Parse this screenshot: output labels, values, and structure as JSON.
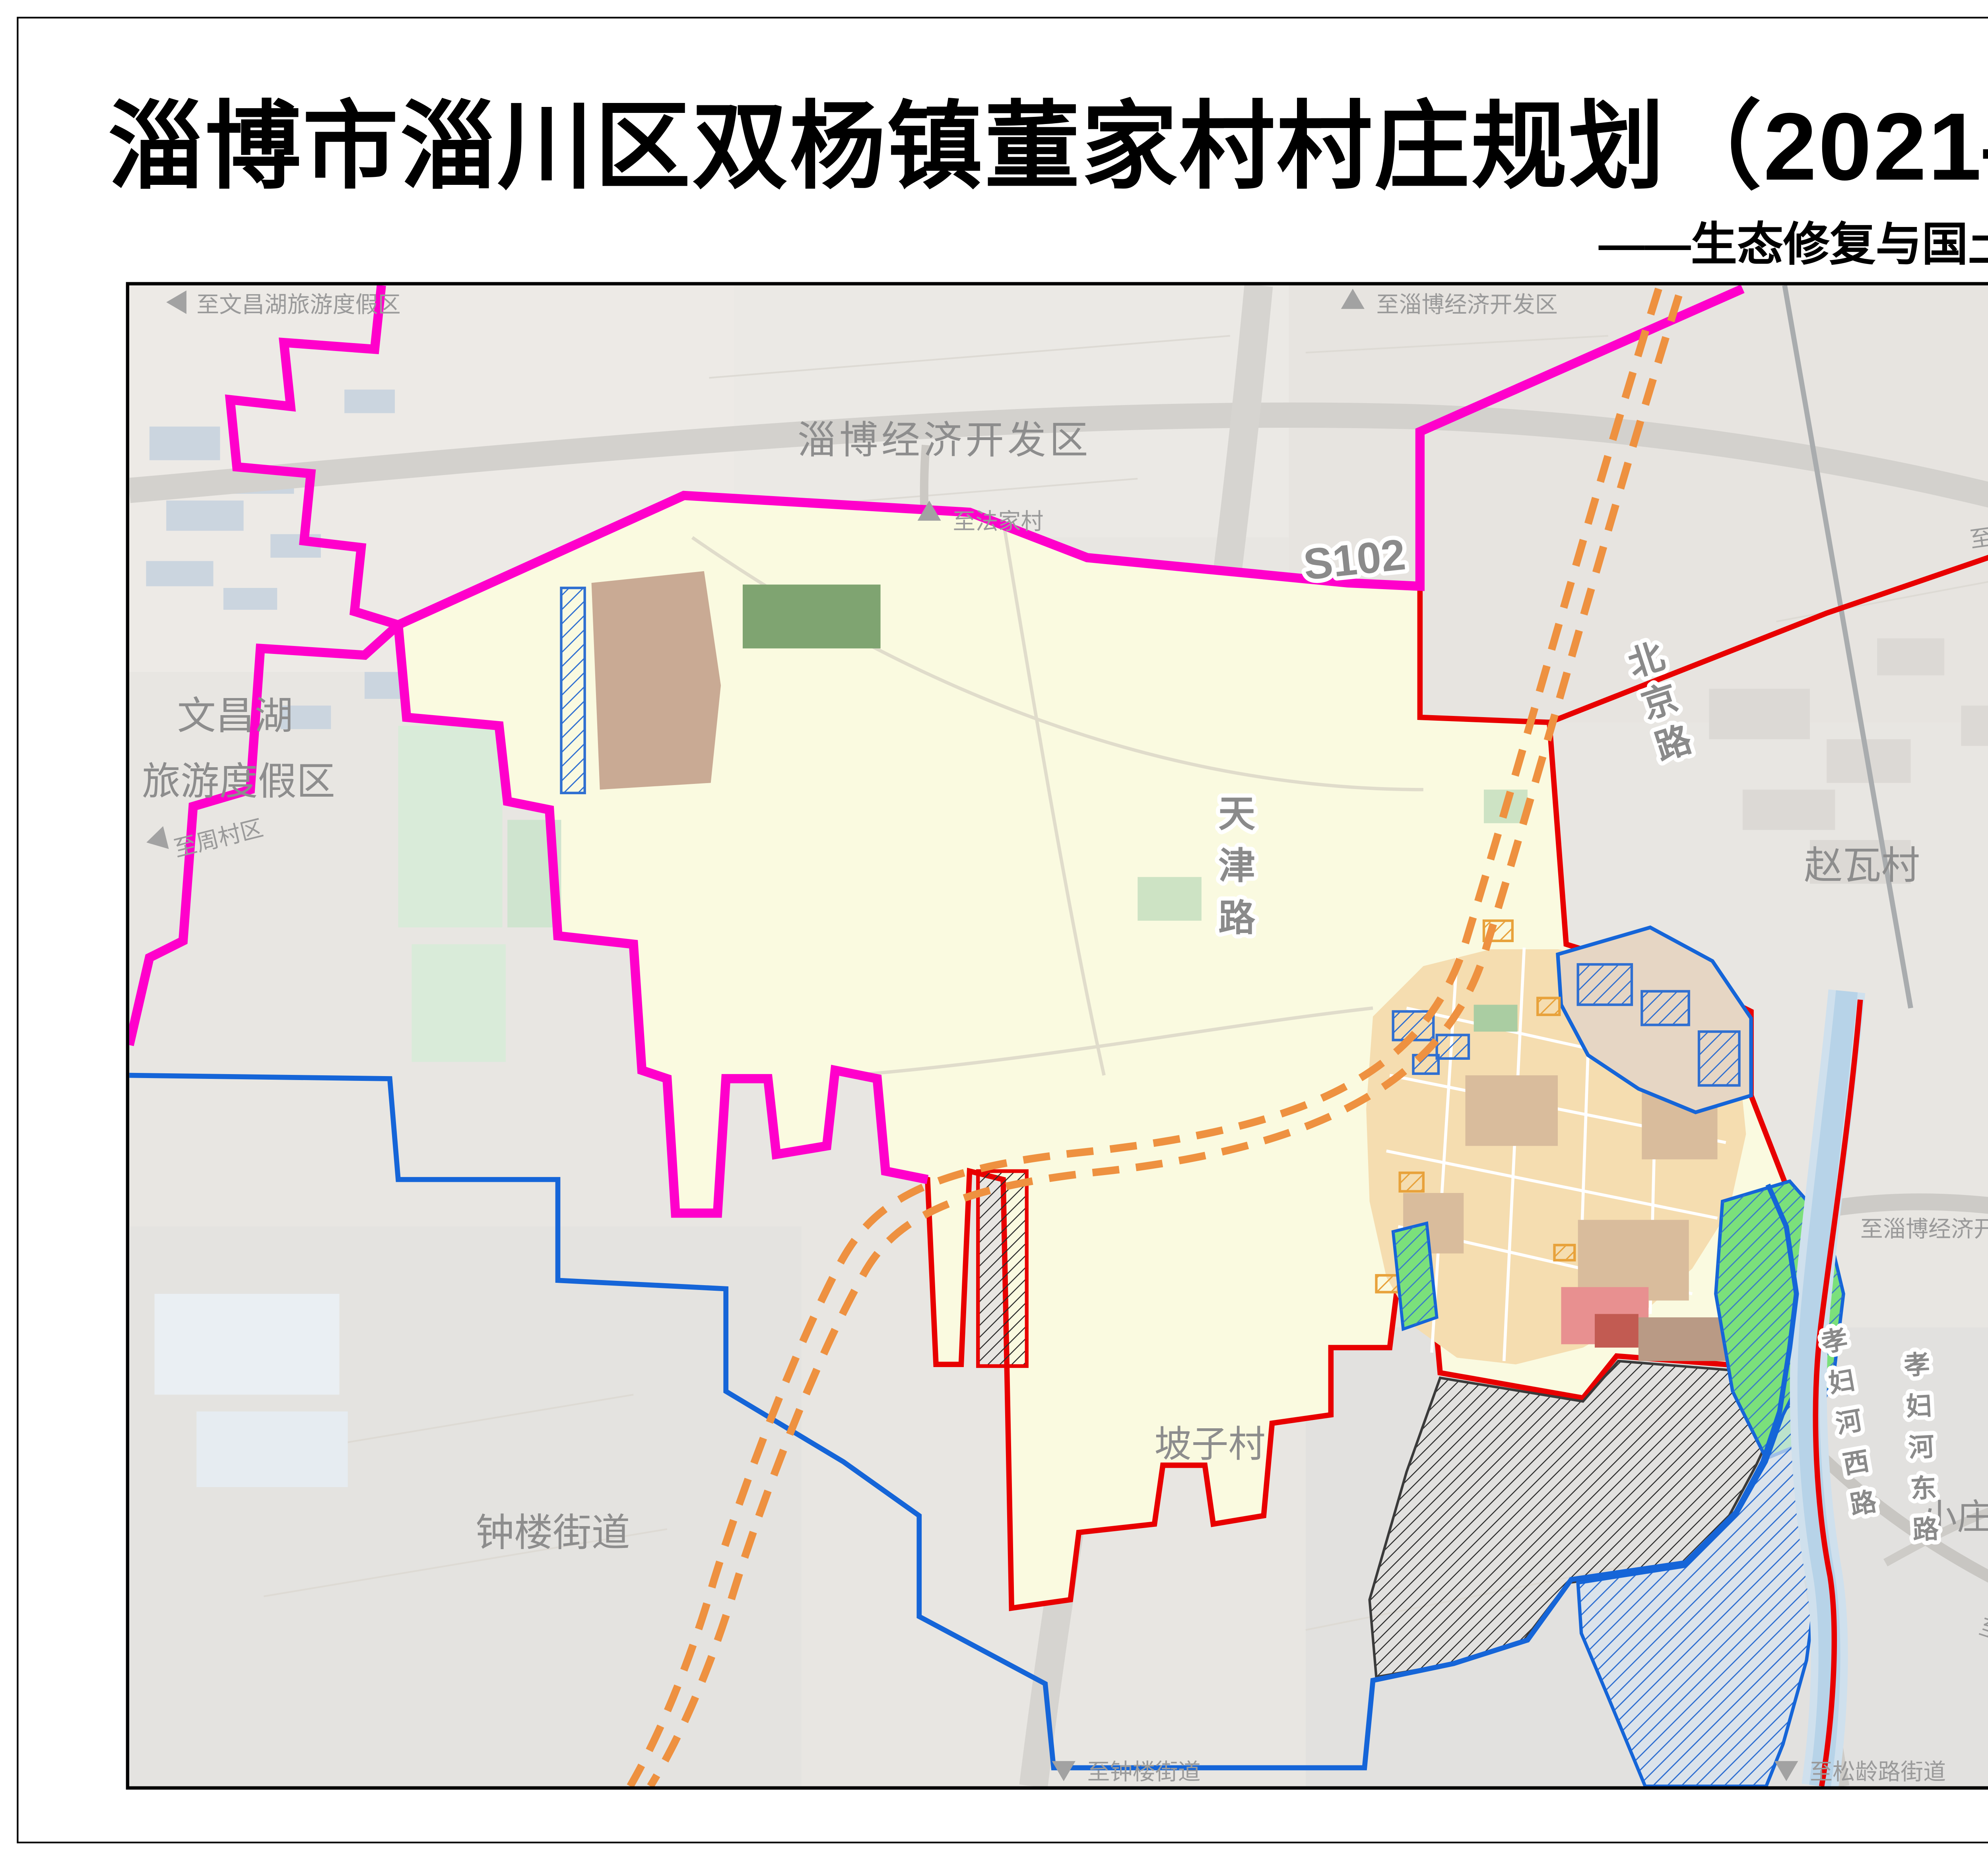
{
  "page": {
    "title": "淄博市淄川区双杨镇董家村村庄规划（2021—2035年）",
    "subtitle": "——生态修复与国土综合整治规划图"
  },
  "compass": {
    "north_label": "N"
  },
  "scale_bar": {
    "ticks": [
      "0",
      "100",
      "200",
      "400M"
    ]
  },
  "legend": {
    "title_char1": "图",
    "title_char2": "例",
    "items": [
      {
        "label": "农用地整治",
        "swatch": "hatch",
        "color": "#E8A23B"
      },
      {
        "label": "建设用地整治",
        "swatch": "hatch",
        "color": "#2F6FD1"
      },
      {
        "label": "城镇开发边界",
        "swatch": "hatch",
        "color": "#3A3A3A"
      },
      {
        "label": "村界",
        "swatch": "outline",
        "color": "#F00000"
      },
      {
        "label": "镇界",
        "swatch": "outline",
        "color": "#1565D8"
      },
      {
        "label": "区界",
        "swatch": "outline",
        "color": "#FF00CB"
      }
    ]
  },
  "map": {
    "area_labels": {
      "zibo_edz": "淄博经济开发区",
      "wenchanghu_line1": "文昌湖",
      "wenchanghu_line2": "旅游度假区",
      "zhaowa": "赵瓦村",
      "zhonglou": "钟楼街道",
      "pozi": "坡子村",
      "xiaozhuang": "小庄村"
    },
    "roads": {
      "s102": "S102",
      "beijing": "北京路",
      "tianjin": "天津路",
      "xiaofuhe_west": "孝妇河西路",
      "xiaofuhe_east": "孝妇河东路"
    },
    "directions": {
      "to_wenchanghu": "至文昌湖旅游度假区",
      "to_zibo_edz_top": "至淄博经济开发区",
      "to_fajia": "至法家村",
      "to_linzi": "至临淄区",
      "to_zhoucun": "至周村区",
      "to_zibo_edz_east": "至淄博经济开发区",
      "to_xiaozhuang": "至小庄村",
      "to_zhonglou": "至钟楼街道",
      "to_songling": "至松龄路街道"
    }
  },
  "colors": {
    "village_boundary": "#E80000",
    "town_boundary": "#1565D8",
    "district_boundary": "#FF00CB",
    "planning_area_fill": "#FAFAE0"
  }
}
